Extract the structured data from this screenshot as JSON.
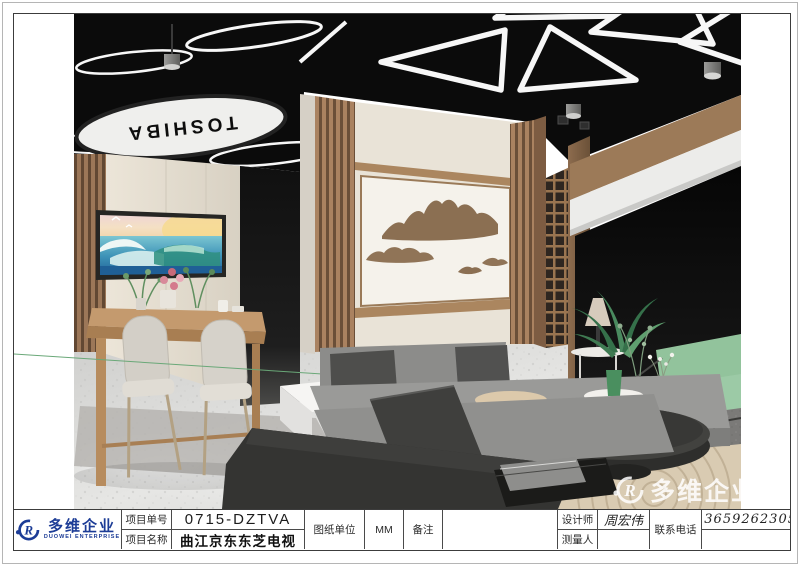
{
  "render": {
    "sign_text": "TOSHIBA",
    "watermark_text": "多维企业",
    "colors": {
      "ceiling": "#0b0b0b",
      "wood": "#a07a55",
      "wall_cream": "#e9e3d7",
      "mountain_brown": "#8b6f52",
      "sofa_gray": "#93938f",
      "sofa_dark": "#343432",
      "green_sofa": "#95c5a0",
      "floor": "#dddddb"
    }
  },
  "title_block": {
    "logo_cn": "多维企业",
    "logo_en": "DUOWEI ENTERPRISE",
    "logo_mark": "R",
    "logo_color": "#1c3c96",
    "project_no_label": "项目单号",
    "project_no_value": "0715-DZTVA",
    "project_name_label": "项目名称",
    "project_name_value": "曲江京东东芝电视",
    "unit_label": "图纸单位",
    "unit_value": "MM",
    "remark_label": "备注",
    "remark_value": "",
    "designer_label": "设计师",
    "designer_value": "周宏伟",
    "surveyor_label": "测量人",
    "surveyor_value": "",
    "phone_label": "联系电话",
    "phone_value": "13659262305"
  }
}
